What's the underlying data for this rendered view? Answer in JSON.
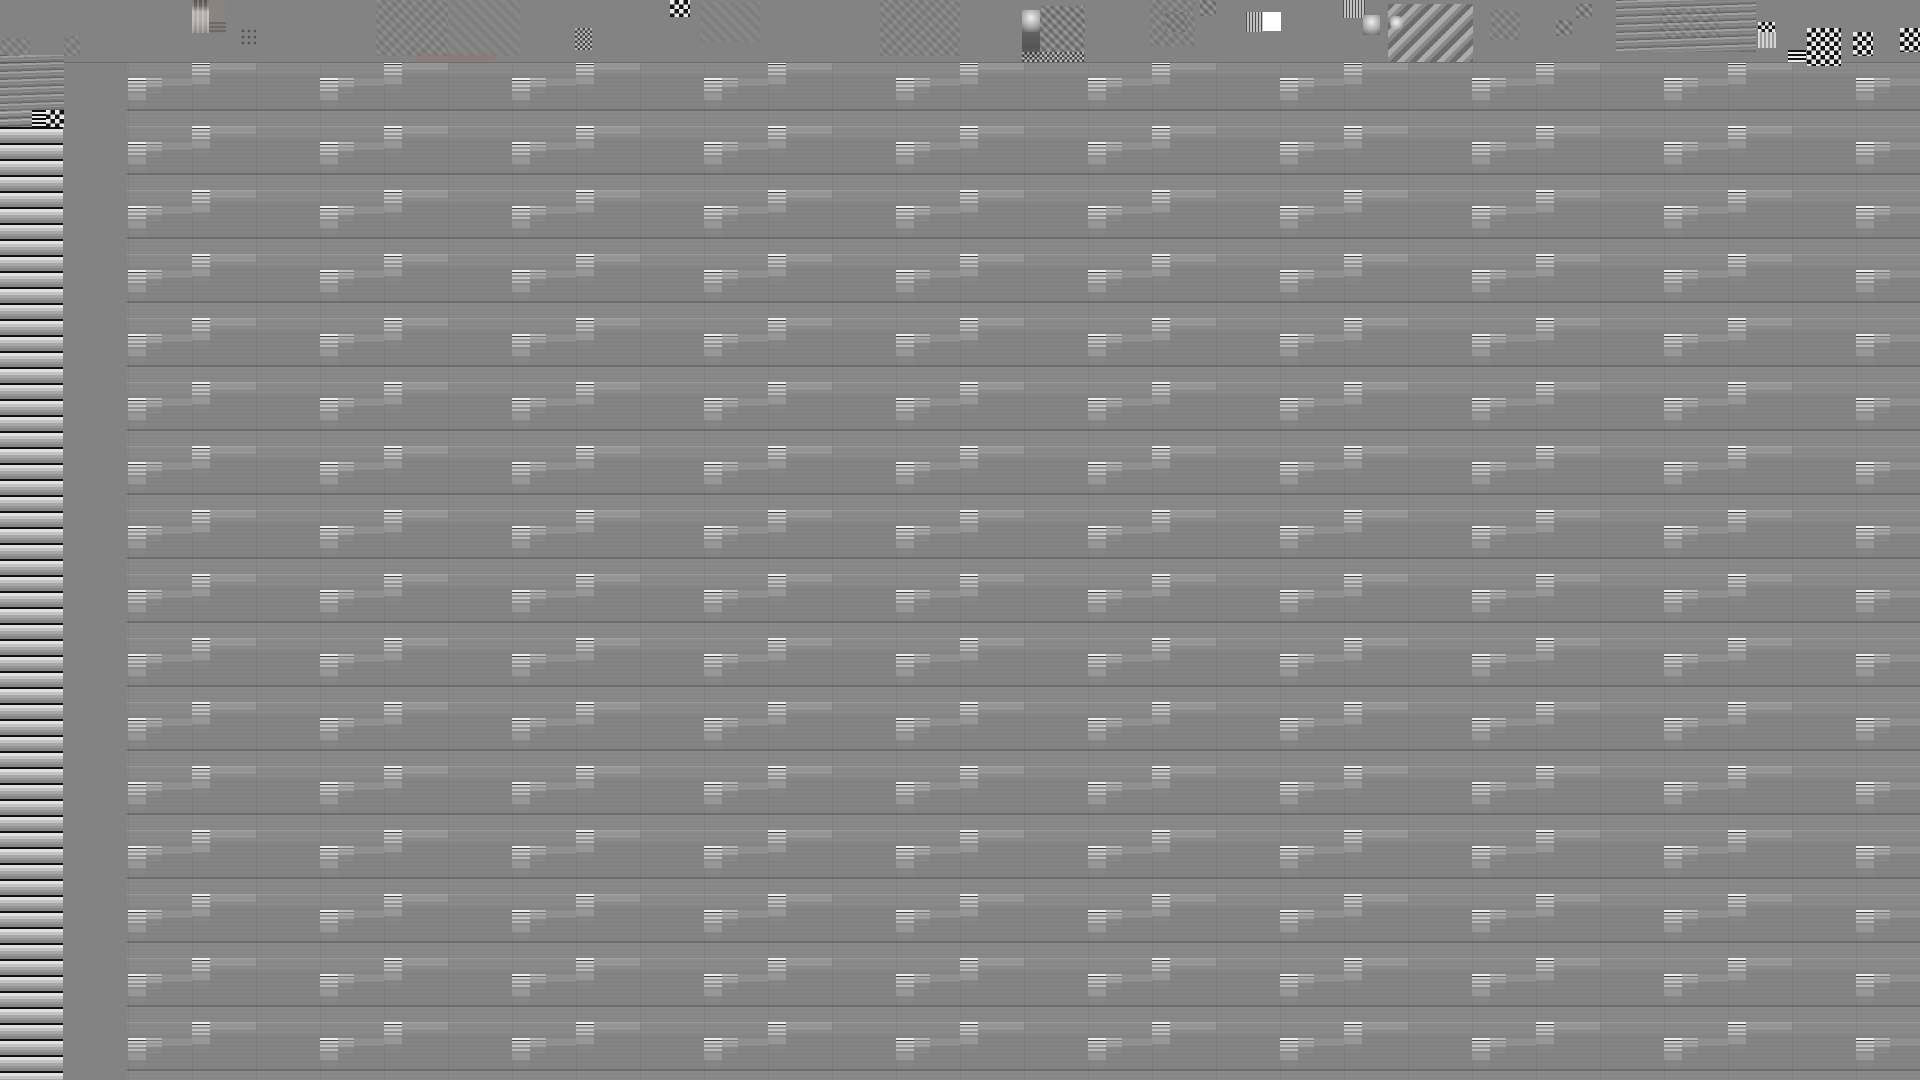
{
  "window": {
    "width": 1920,
    "height": 1080
  },
  "visible_text": [],
  "colors": {
    "background": "#838383",
    "white": "#ffffff",
    "near_black": "#141414",
    "stripe_light": "#e6e6e6",
    "pink_top": "#585253",
    "pink_body": "#b7aeaf",
    "brown": "#8b8380",
    "warm_smudge": "rgba(152,112,112,0.28)"
  },
  "top_band": {
    "x": 0,
    "y": 0,
    "width": 1920,
    "height": 62
  },
  "left_band": {
    "x": 0,
    "y": 127,
    "width": 63,
    "height": 953,
    "stripe_period": 16
  },
  "grid": {
    "origin_x": 64,
    "origin_y": 62,
    "col_period": 192,
    "col_count": 10,
    "row_period": 64,
    "block_width": 18,
    "a_col_x": 128,
    "b_col_x": 192,
    "a_segment_offset": 16,
    "b_segment_offset": 0,
    "segment_height": 16,
    "ext_width": 46
  },
  "noise_blocks": [
    {
      "x": 192,
      "y": 0,
      "w": 17,
      "h": 33,
      "type": "pink-gradient"
    },
    {
      "x": 209,
      "y": 0,
      "w": 17,
      "h": 22,
      "type": "brown-block"
    },
    {
      "x": 209,
      "y": 22,
      "w": 17,
      "h": 11,
      "type": "hlines-dark"
    },
    {
      "x": 240,
      "y": 28,
      "w": 16,
      "h": 18,
      "type": "dot-grid"
    },
    {
      "x": 64,
      "y": 36,
      "w": 16,
      "h": 20,
      "type": "soft-noise"
    },
    {
      "x": 0,
      "y": 38,
      "w": 30,
      "h": 20,
      "type": "soft-noise"
    },
    {
      "x": 376,
      "y": 0,
      "w": 72,
      "h": 56,
      "type": "soft-noise"
    },
    {
      "x": 448,
      "y": 0,
      "w": 72,
      "h": 56,
      "type": "soft-noise-light"
    },
    {
      "x": 575,
      "y": 28,
      "w": 17,
      "h": 22,
      "type": "checker-fine"
    },
    {
      "x": 670,
      "y": 0,
      "w": 20,
      "h": 17,
      "type": "checker-bw"
    },
    {
      "x": 700,
      "y": 2,
      "w": 60,
      "h": 40,
      "type": "soft-noise-light"
    },
    {
      "x": 415,
      "y": 53,
      "w": 80,
      "h": 8,
      "type": "warm-smudge"
    },
    {
      "x": 880,
      "y": 0,
      "w": 80,
      "h": 56,
      "type": "soft-noise"
    },
    {
      "x": 1040,
      "y": 6,
      "w": 45,
      "h": 50,
      "type": "mottle"
    },
    {
      "x": 1022,
      "y": 10,
      "w": 18,
      "h": 22,
      "type": "light-blob"
    },
    {
      "x": 1022,
      "y": 32,
      "w": 18,
      "h": 26,
      "type": "dark-block"
    },
    {
      "x": 1022,
      "y": 52,
      "w": 63,
      "h": 10,
      "type": "checker-fine"
    },
    {
      "x": 1150,
      "y": 0,
      "w": 45,
      "h": 46,
      "type": "soft-noise"
    },
    {
      "x": 1165,
      "y": 12,
      "w": 22,
      "h": 20,
      "type": "mottle"
    },
    {
      "x": 1200,
      "y": 0,
      "w": 16,
      "h": 16,
      "type": "mottle"
    },
    {
      "x": 1246,
      "y": 12,
      "w": 17,
      "h": 20,
      "type": "v-lines"
    },
    {
      "x": 1263,
      "y": 12,
      "w": 18,
      "h": 19,
      "type": "white-square"
    },
    {
      "x": 1343,
      "y": 0,
      "w": 22,
      "h": 18,
      "type": "v-lines"
    },
    {
      "x": 1363,
      "y": 15,
      "w": 17,
      "h": 20,
      "type": "light-blob"
    },
    {
      "x": 1388,
      "y": 4,
      "w": 85,
      "h": 58,
      "type": "diag-stripes"
    },
    {
      "x": 1390,
      "y": 16,
      "w": 14,
      "h": 14,
      "type": "gradient-dot"
    },
    {
      "x": 1490,
      "y": 10,
      "w": 30,
      "h": 30,
      "type": "soft-noise"
    },
    {
      "x": 1556,
      "y": 20,
      "w": 16,
      "h": 16,
      "type": "mottle"
    },
    {
      "x": 1576,
      "y": 4,
      "w": 16,
      "h": 14,
      "type": "mottle"
    },
    {
      "x": 1616,
      "y": 0,
      "w": 140,
      "h": 52,
      "type": "wavy"
    },
    {
      "x": 1660,
      "y": 8,
      "w": 60,
      "h": 30,
      "type": "soft-noise"
    },
    {
      "x": 1758,
      "y": 22,
      "w": 18,
      "h": 26,
      "type": "flag-gradient"
    },
    {
      "x": 1788,
      "y": 50,
      "w": 18,
      "h": 12,
      "type": "hstripes-bw"
    },
    {
      "x": 1807,
      "y": 28,
      "w": 34,
      "h": 38,
      "type": "checker-bw"
    },
    {
      "x": 1853,
      "y": 32,
      "w": 20,
      "h": 24,
      "type": "checker-bw"
    },
    {
      "x": 1900,
      "y": 28,
      "w": 20,
      "h": 24,
      "type": "checker-bw"
    },
    {
      "x": 0,
      "y": 55,
      "w": 64,
      "h": 72,
      "type": "wavy"
    },
    {
      "x": 0,
      "y": 110,
      "w": 32,
      "h": 17,
      "type": "wavy"
    },
    {
      "x": 32,
      "y": 110,
      "w": 14,
      "h": 17,
      "type": "hstripes-bw"
    },
    {
      "x": 46,
      "y": 110,
      "w": 18,
      "h": 17,
      "type": "checker-bw"
    }
  ]
}
